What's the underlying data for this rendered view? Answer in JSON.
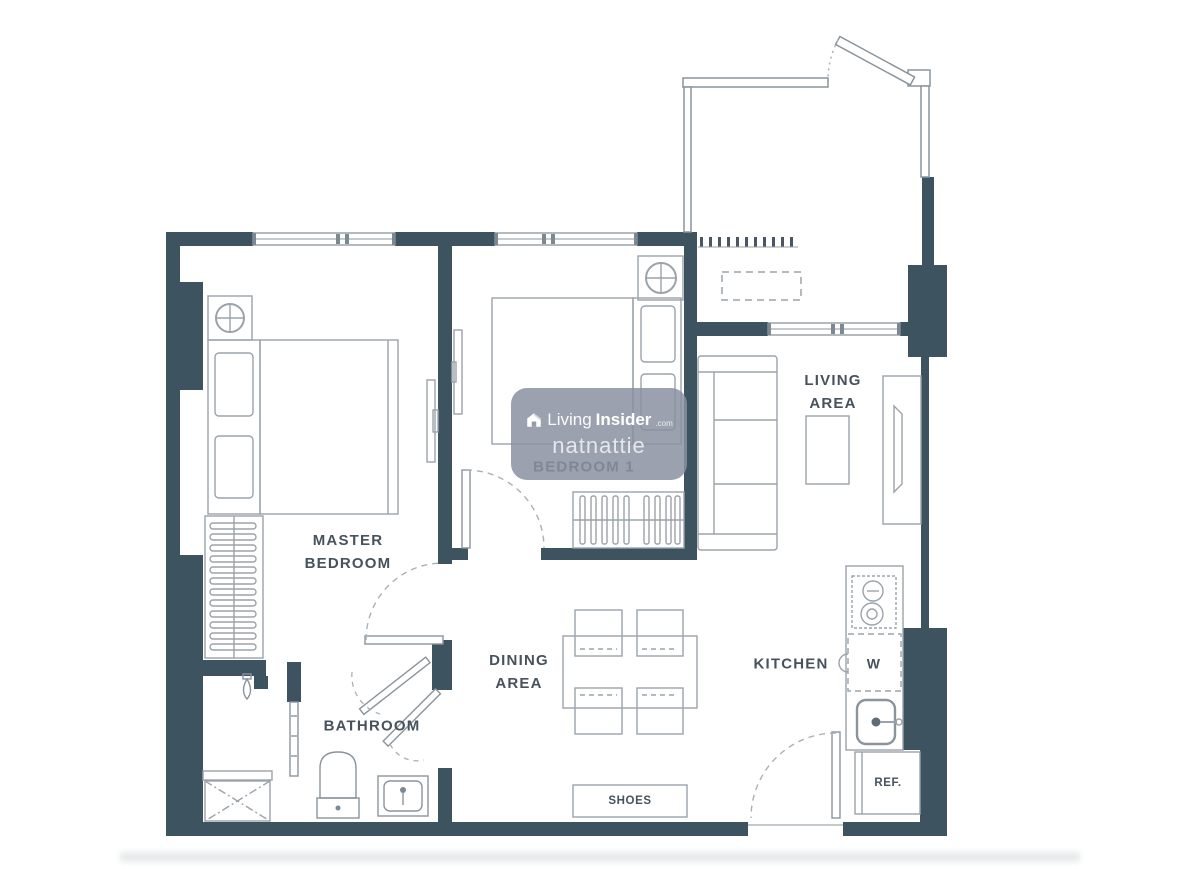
{
  "plan": {
    "rooms": {
      "master_bedroom": {
        "lines": [
          "MASTER",
          "BEDROOM"
        ]
      },
      "bedroom_1": {
        "label": "BEDROOM 1"
      },
      "living_area": {
        "lines": [
          "LIVING",
          "AREA"
        ]
      },
      "dining_area": {
        "lines": [
          "DINING",
          "AREA"
        ]
      },
      "kitchen": {
        "label": "KITCHEN"
      },
      "bathroom": {
        "label": "BATHROOM"
      }
    },
    "fixtures": {
      "washer": "W",
      "refrigerator": "REF.",
      "shoe_cabinet": "SHOES"
    }
  },
  "watermark": {
    "brand_prefix": "Living",
    "brand_suffix": "Insider",
    "brand_tld": ".com",
    "username": "natnattie",
    "logo_icon": "house-icon"
  },
  "colors": {
    "wall": "#3d5360",
    "furniture_line": "#9aa3ab",
    "furniture_dark": "#7d8992",
    "label_text": "#47525c",
    "watermark_bg": "rgba(138,144,160,0.85)",
    "watermark_text": "#ffffff",
    "background": "#ffffff"
  }
}
